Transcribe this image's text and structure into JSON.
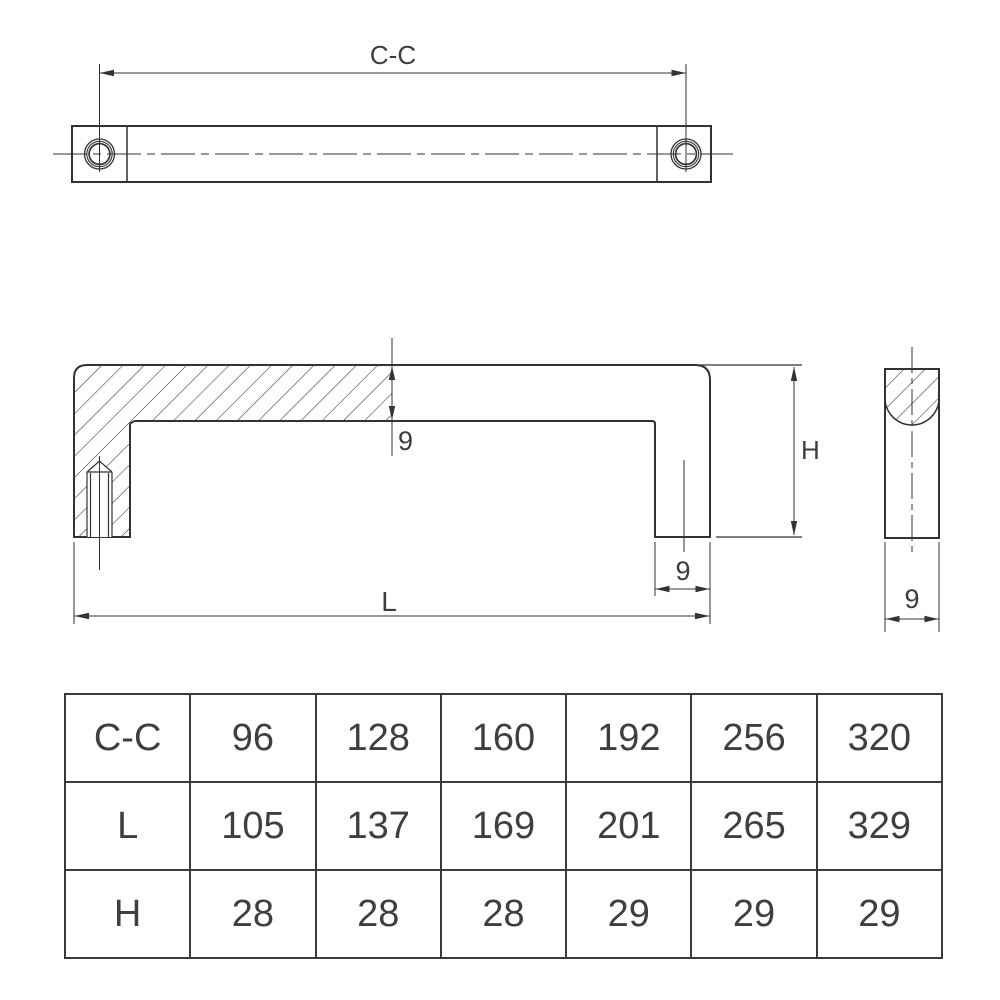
{
  "drawing": {
    "stroke_color": "#333333",
    "labels": {
      "cc": "C-C",
      "bar_thickness": "9",
      "height": "H",
      "leg_width": "9",
      "length": "L",
      "side_width": "9"
    }
  },
  "chart_data": {
    "type": "table",
    "categories": [
      "size1",
      "size2",
      "size3",
      "size4",
      "size5",
      "size6"
    ],
    "series": [
      {
        "name": "C-C",
        "values": [
          96,
          128,
          160,
          192,
          256,
          320
        ]
      },
      {
        "name": "L",
        "values": [
          105,
          137,
          169,
          201,
          265,
          329
        ]
      },
      {
        "name": "H",
        "values": [
          28,
          28,
          28,
          29,
          29,
          29
        ]
      }
    ]
  },
  "table": {
    "rows": [
      {
        "label": "C-C",
        "values": [
          "96",
          "128",
          "160",
          "192",
          "256",
          "320"
        ]
      },
      {
        "label": "L",
        "values": [
          "105",
          "137",
          "169",
          "201",
          "265",
          "329"
        ]
      },
      {
        "label": "H",
        "values": [
          "28",
          "28",
          "28",
          "29",
          "29",
          "29"
        ]
      }
    ]
  }
}
